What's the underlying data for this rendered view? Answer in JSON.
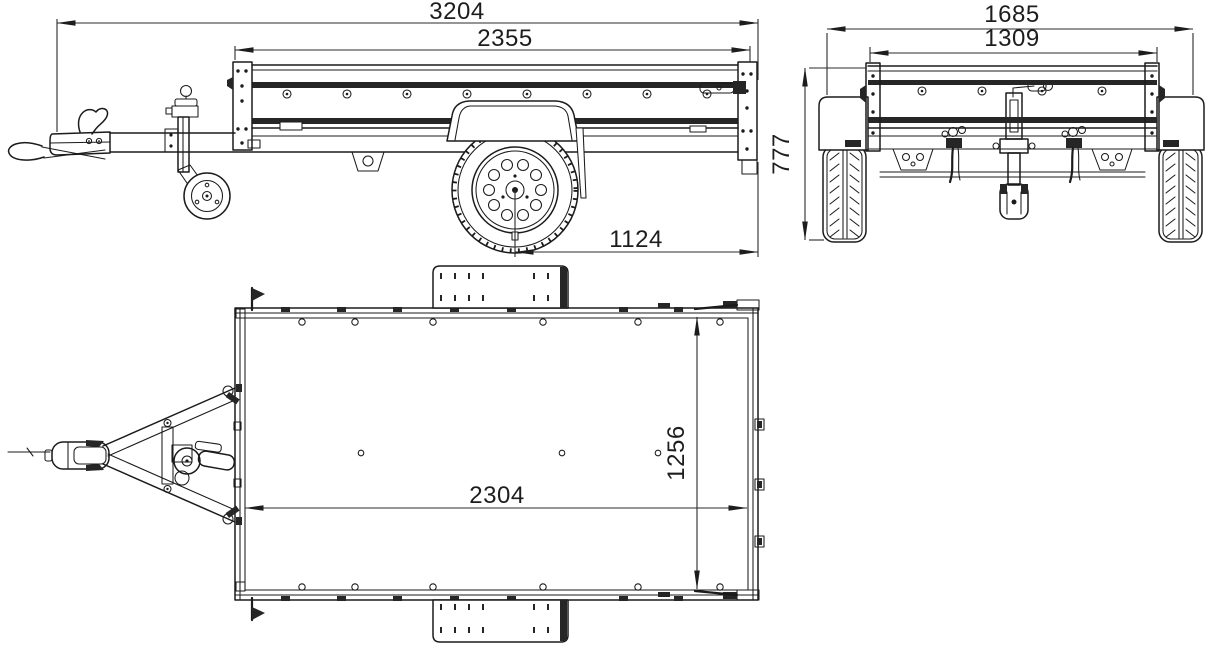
{
  "colors": {
    "line": "#1b1b1b",
    "dimension_line": "#2b2b2b",
    "text": "#1d1d1d",
    "dark_fill": "#262626",
    "background": "#ffffff"
  },
  "views": {
    "side": {
      "dims": {
        "overall_length": "3204",
        "box_length": "2355",
        "axle_to_rear": "1124"
      }
    },
    "rear": {
      "dims": {
        "overall_width": "1685",
        "inner_width": "1309",
        "height": "777"
      }
    },
    "top": {
      "dims": {
        "floor_length": "2304",
        "floor_width": "1256"
      }
    }
  }
}
